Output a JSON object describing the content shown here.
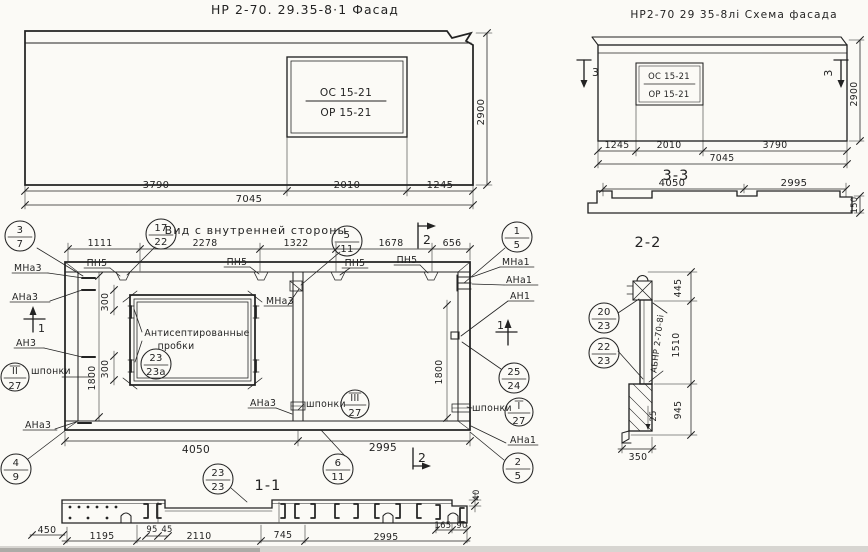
{
  "sheet": {
    "background": "#fbfaf6",
    "ink": "#232323"
  },
  "titles": {
    "facade": "НР 2-70. 29.35-8·1 Фасад",
    "schema": "НР2-70 29 35-8лі Схема фасада",
    "inner": "Вид с внутренней стороны",
    "s33": "3-3",
    "s22": "2-2",
    "s11": "1-1"
  },
  "marks": {
    "os": "ОС 15-21",
    "or": "ОР 15-21",
    "stamp": "АБНР 2-70-8і"
  },
  "dims": {
    "d3790": "3790",
    "d2010": "2010",
    "d1245": "1245",
    "d7045": "7045",
    "d2900": "2900",
    "d4050": "4050",
    "d2995": "2995",
    "d150": "150",
    "d1111": "1111",
    "d2278": "2278",
    "d1322": "1322",
    "d1678": "1678",
    "d656": "656",
    "d300": "300",
    "d1800": "1800",
    "d445": "445",
    "d1510": "1510",
    "d945": "945",
    "d25": "25",
    "d350": "350",
    "d450": "450",
    "d95": "95",
    "d45": "45",
    "d1195": "1195",
    "d2110": "2110",
    "d745": "745",
    "d165": "165",
    "d90": "90",
    "d40": "40"
  },
  "labels": {
    "mna3": "МНа3",
    "ana3": "АНа3",
    "an3": "АН3",
    "mna1": "МНа1",
    "ana1": "АНа1",
    "an1": "АН1",
    "pn5": "ПН5",
    "shponki": "шпонки",
    "note1": "Антисептированные",
    "note2": "пробки"
  },
  "markers": {
    "m1": "1",
    "m2": "2",
    "m3": "3"
  },
  "bubbles": {
    "b37": {
      "top": "3",
      "bot": "7"
    },
    "b1722": {
      "top": "17",
      "bot": "22"
    },
    "b511": {
      "top": "5",
      "bot": "11"
    },
    "b15": {
      "top": "1",
      "bot": "5"
    },
    "b2323a": {
      "top": "23",
      "bot": "23а"
    },
    "bII27": {
      "top": "II",
      "bot": "27"
    },
    "b2524": {
      "top": "25",
      "bot": "24"
    },
    "bIII27": {
      "top": "III",
      "bot": "27"
    },
    "bI27": {
      "top": "I",
      "bot": "27"
    },
    "b611": {
      "top": "6",
      "bot": "11"
    },
    "b25": {
      "top": "2",
      "bot": "5"
    },
    "b49": {
      "top": "4",
      "bot": "9"
    },
    "b2323": {
      "top": "23",
      "bot": "23"
    },
    "b2023": {
      "top": "20",
      "bot": "23"
    },
    "b2223": {
      "top": "22",
      "bot": "23"
    }
  }
}
